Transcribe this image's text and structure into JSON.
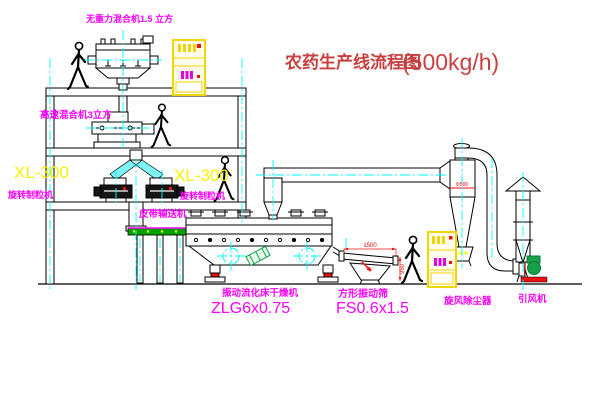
{
  "title": {
    "name": "农药生产线流程图",
    "capacity": "(500kg/h)"
  },
  "equipment": {
    "gravity_mixer": {
      "label": "无重力混合机1.5 立方"
    },
    "high_speed_mixer": {
      "label": "高速混合机3立方"
    },
    "granulator_left": {
      "model": "XL-300",
      "label": "旋转制粒机"
    },
    "granulator_right": {
      "model": "XL-300",
      "label": "旋转制粒机"
    },
    "belt_conveyor": {
      "label": "皮带输送机"
    },
    "fluid_bed_dryer": {
      "label": "振动流化床干燥机",
      "model": "ZLG6x0.75"
    },
    "vibrating_sieve": {
      "label": "方形振动筛",
      "model": "FS0.6x1.5"
    },
    "cyclone": {
      "label": "旋风除尘器",
      "dim": "Φ500"
    },
    "fan": {
      "label": "引风机"
    }
  },
  "dimensions": {
    "sieve_length": "1500",
    "sieve_height": "950"
  },
  "colors": {
    "label_magenta": "#ff00ff",
    "model_yellow": "#f8f000",
    "title_red": "#c84040",
    "centerline_cyan": "#00ffff",
    "accent_red": "#ee1111",
    "conveyor_green": "#00a000",
    "cabinet_yellow": "#f2d400"
  }
}
